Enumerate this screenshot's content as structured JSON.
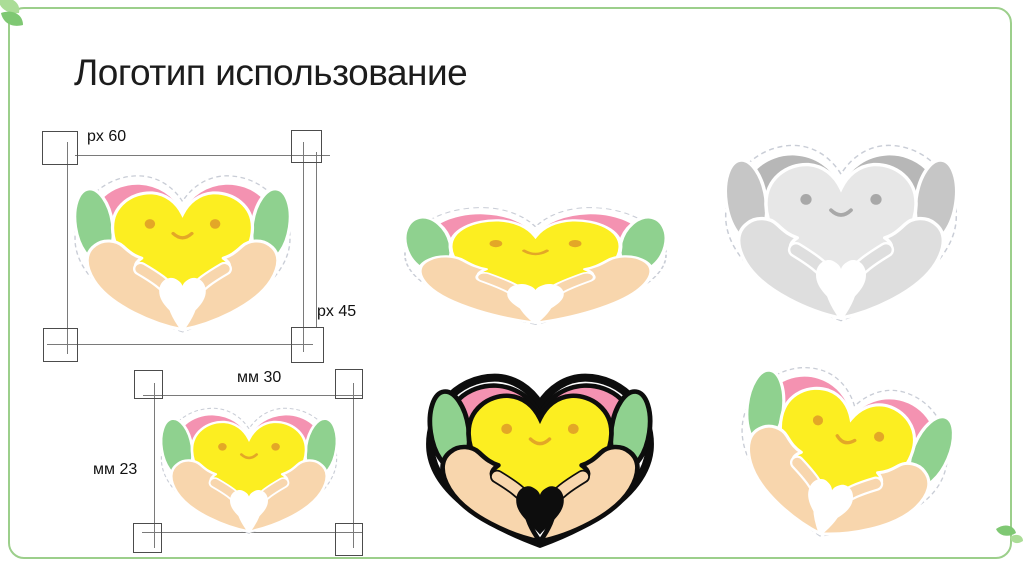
{
  "slide": {
    "title": "Логотип использование"
  },
  "measurements": {
    "px_frame": {
      "width_label": "px 60",
      "height_label": "px 45"
    },
    "mm_frame": {
      "width_label": "мм 30",
      "height_label": "мм 23"
    }
  },
  "icons": {
    "logo": "heart-in-hands-logo",
    "corner_decoration": "leaf-icon"
  },
  "colors": {
    "pink": "#f492b1",
    "green": "#8fd18f",
    "yellow": "#fcee21",
    "hand": "#f8d6ad",
    "face": "#e3a727",
    "sticker_dash": "#c9cdd6",
    "outline": "#0d0d0d",
    "gray_pink": "#b7b7b7",
    "gray_green": "#c6c6c6",
    "gray_yellow": "#e7e7e7",
    "gray_hand": "#dedede",
    "gray_face": "#a8a8a8",
    "border_green": "#9ccf8b",
    "leaf_dark": "#7fc873",
    "leaf_light": "#abdd97",
    "frame_box": "#4c4c4c",
    "frame_line": "#7a7a7a",
    "title_text": "#1c1c1c",
    "label_text": "#111111"
  }
}
